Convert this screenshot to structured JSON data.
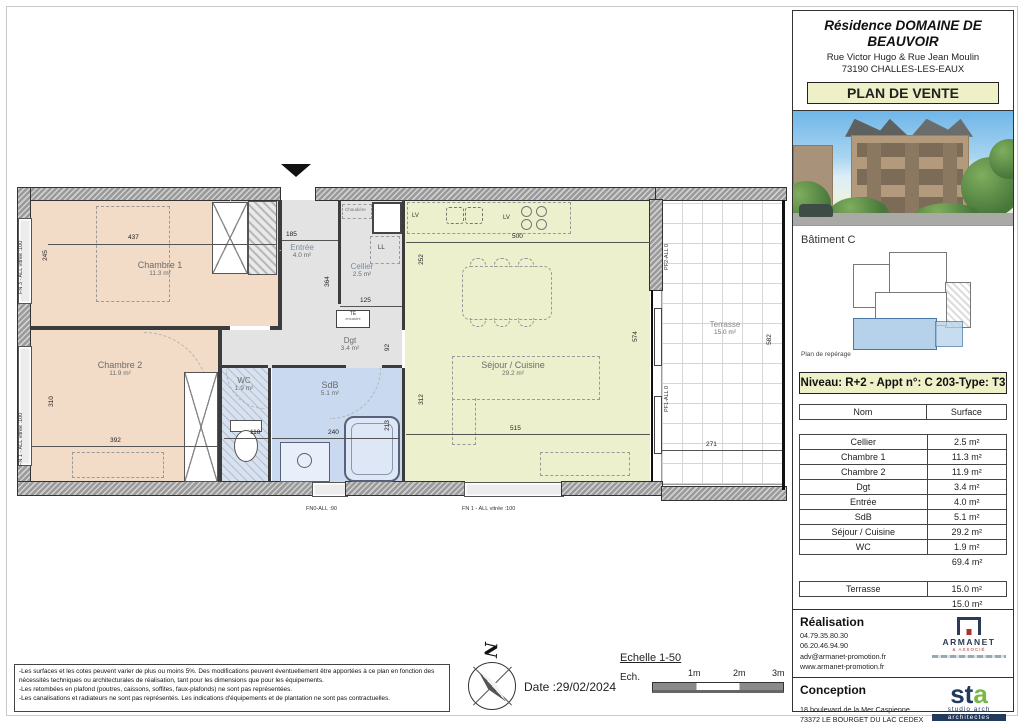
{
  "colors": {
    "accent_khaki": "#eef0c8",
    "room_salmon": "#f2dbc7",
    "room_blue": "#c9daf0",
    "room_grey": "#e3e3e3",
    "room_sejour_green": "#edf0cc",
    "reperage_highlight": "#b5d2ea"
  },
  "header": {
    "title": "Résidence DOMAINE DE BEAUVOIR",
    "address_line1": "Rue Victor Hugo & Rue Jean Moulin",
    "address_line2": "73190 CHALLES-LES-EAUX",
    "plan_label": "PLAN DE VENTE"
  },
  "reperage": {
    "batiment": "Bâtiment C",
    "caption": "Plan de repérage"
  },
  "apartment": {
    "info": "Niveau: R+2  - Appt n°: C 203-Type: T3"
  },
  "surface_table": {
    "columns": [
      "Nom",
      "Surface"
    ],
    "rows": [
      [
        "Cellier",
        "2.5 m²"
      ],
      [
        "Chambre 1",
        "11.3 m²"
      ],
      [
        "Chambre 2",
        "11.9 m²"
      ],
      [
        "Dgt",
        "3.4 m²"
      ],
      [
        "Entrée",
        "4.0 m²"
      ],
      [
        "SdB",
        "5.1 m²"
      ],
      [
        "Séjour / Cuisine",
        "29.2 m²"
      ],
      [
        "WC",
        "1.9 m²"
      ]
    ],
    "total": "69.4 m²",
    "terrace_row": [
      "Terrasse",
      "15.0 m²"
    ],
    "terrace_total": "15.0 m²"
  },
  "realisation": {
    "title": "Réalisation",
    "phone1": "04.79.35.80.30",
    "phone2": "06.20.46.94.90",
    "email": "adv@armanet-promotion.fr",
    "website": "www.armanet-promotion.fr",
    "logo_name": "ARMANET",
    "logo_sub": "& ASSOCIÉ"
  },
  "conception": {
    "title": "Conception",
    "address_line1": "18 boulevard de la Mer Caspienne",
    "address_line2": "73372 LE BOURGET DU LAC CEDEX",
    "logo_st": "st",
    "logo_a": "a",
    "logo_sub1": "studio arch",
    "logo_sub2": "architectes"
  },
  "notes": {
    "items": [
      "-Les surfaces et les cotes peuvent varier de plus ou moins 5%. Des modifications peuvent éventuellement être apportées à ce plan en fonction des nécessités techniques ou architecturales de réalisation, tant pour les dimensions que pour les équipements.",
      "-Les retombées en plafond (poutres, caissons, soffites, faux-plafonds) ne sont pas représentées.",
      "-Les canalisations et radiateurs ne sont pas représentés. Les indications d'équipements et de plantation ne sont pas contractuelles."
    ]
  },
  "footer": {
    "north": "N",
    "date": "Date :29/02/2024",
    "scale_title": "Echelle 1-50",
    "scale_label": "Ech.",
    "scale_marks": [
      "1m",
      "2m",
      "3m"
    ]
  },
  "plan": {
    "rooms": {
      "chambre1": {
        "name": "Chambre 1",
        "area": "11.3 m²"
      },
      "chambre2": {
        "name": "Chambre 2",
        "area": "11.9 m²"
      },
      "entree": {
        "name": "Entrée",
        "area": "4.0 m²"
      },
      "cellier": {
        "name": "Cellier",
        "area": "2.5 m²"
      },
      "dgt": {
        "name": "Dgt",
        "area": "3.4 m²"
      },
      "wc": {
        "name": "WC",
        "area": "1.9 m²"
      },
      "sdb": {
        "name": "SdB",
        "area": "5.1 m²"
      },
      "sejour": {
        "name": "Séjour / Cuisine",
        "area": "29.2 m²"
      },
      "terrasse": {
        "name": "Terrasse",
        "area": "15.0 m²"
      }
    },
    "dims": {
      "chambre1_w": "437",
      "chambre1_h": "245",
      "chambre2_w": "392",
      "chambre2_h": "310",
      "entree_w": "185",
      "cellier_h": "364",
      "cellier_w": "125",
      "dgt_h": "92",
      "wc_w": "110",
      "sdb_w": "240",
      "sdb_h": "213",
      "sejour_top_w": "500",
      "sejour_left_h": "252",
      "sejour_right_h": "574",
      "sejour_low_h": "312",
      "sejour_w": "515",
      "terrasse_w": "271",
      "terrasse_h": "582"
    },
    "labels": {
      "ll": "LL",
      "lv1": "LV",
      "lv2": "LV",
      "chaudiere": "Chaudière",
      "te1": "TE",
      "te2": "encastré",
      "fn0_bottom": "FN0-ALL :90",
      "fn1_bottom": "FN 1 - ALL vitrée :100",
      "fn3_left": "FN 3 - ALL vitrée :100",
      "fn1_left": "FN 1 - ALL vitrée :100",
      "pf2": "PF2-ALL  0",
      "pf1": "PF1-ALL  0"
    }
  }
}
